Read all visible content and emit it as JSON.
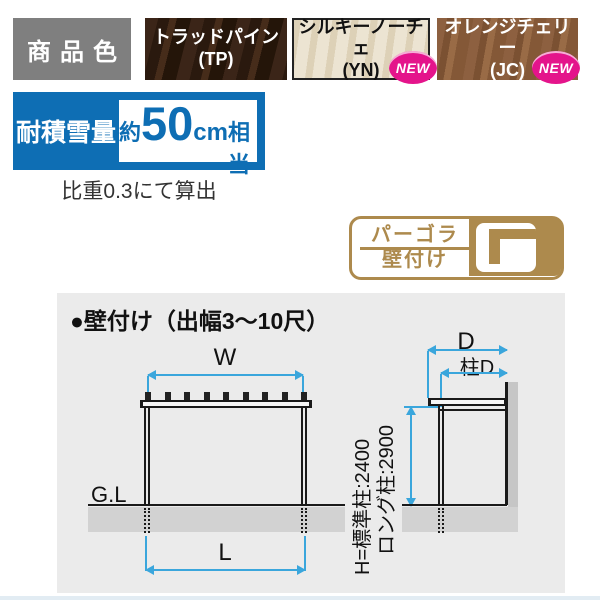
{
  "colors": {
    "banner-blue": "#0e6eb4",
    "dim-blue": "#3aa6dc",
    "gold": "#ad8a4d",
    "magenta": "#e4148b",
    "label-gray": "#7f7f7f",
    "panel-gray": "#ebebeb"
  },
  "product_colors": {
    "label": "商品色",
    "new_badge_label": "NEW",
    "swatches": [
      {
        "name": "トラッドパイン",
        "code": "(TP)",
        "is_new": false
      },
      {
        "name": "シルキーノーチェ",
        "code": "(YN)",
        "is_new": true
      },
      {
        "name": "オレンジチェリー",
        "code": "(JC)",
        "is_new": true
      }
    ]
  },
  "snow_load": {
    "label": "耐積雪量",
    "value_prefix": "約",
    "value_number": "50",
    "value_unit": "cm",
    "value_suffix": "相当",
    "note": "比重0.3にて算出"
  },
  "type_badge": {
    "line1": "パーゴラ",
    "line2": "壁付け",
    "icon": "wall-mounted-pergola-profile-icon"
  },
  "diagram": {
    "title": "●壁付け（出幅3～10尺）",
    "front_view": {
      "width_label": "W",
      "length_label": "L",
      "ground_label": "G.L"
    },
    "side_view": {
      "depth_label": "D",
      "post_depth_label": "柱D",
      "height_label_line1": "H=標準柱:2400",
      "height_label_line2": "ロング柱:2900"
    }
  }
}
